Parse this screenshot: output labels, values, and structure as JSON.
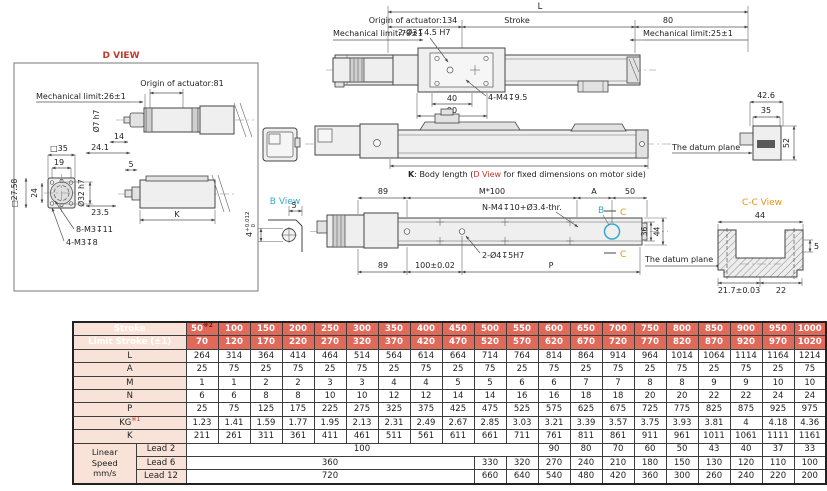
{
  "colors": {
    "header_bg": "#e0695a",
    "label_bg": "#f9e3d8",
    "accent_red": "#c0392b",
    "accent_cyan": "#33acce",
    "accent_orange": "#e8940e",
    "line": "#444444"
  },
  "d_view": {
    "title": "D VIEW",
    "origin": "Origin of actuator:81",
    "mech_limit": "Mechanical limit:26±1",
    "shaft_dia": "Ø7 h7",
    "d14": "14",
    "d24_1": "24.1",
    "sq35": "□35",
    "d19": "19",
    "sq27_58": "□27.58",
    "d24": "24",
    "dia32": "Ø32 h7",
    "d23_5": "23.5",
    "d5": "5",
    "k": "K",
    "thread8": "8-M3↧11",
    "thread4": "4-M3↧8"
  },
  "top_view": {
    "l": "L",
    "origin": "Origin of actuator:134",
    "stroke": "Stroke",
    "d80": "80",
    "mech_limit_left": "Mechanical limit:79±1",
    "mech_limit_right": "Mechanical limit:25±1",
    "holes": "2-Ø3↧4.5 H7",
    "threads": "4-M4↧9.5",
    "d40": "40",
    "d90": "90"
  },
  "front_view": {
    "k_bold": "K",
    "k_mid": ": Body length (",
    "k_dview": "D View",
    "k_post": " for fixed dimensions on motor side)",
    "datum": "The datum plane",
    "d42_6": "42.6",
    "d35": "35",
    "d52": "52"
  },
  "bottom_view": {
    "title": "B View",
    "d5": "5",
    "tol_base": "4",
    "tol_hi": "+0.012",
    "tol_lo": "0",
    "d89_top": "89",
    "m100": "M*100",
    "a": "A",
    "d50": "50",
    "n_threads": "N-M4↧10+Ø3.4-thr.",
    "b": "B",
    "c": "C",
    "d36": "36",
    "d44": "44",
    "d89_bot": "89",
    "d100": "100±0.02",
    "p": "P",
    "holes": "2-Ø4↧5H7",
    "datum": "The datum plane"
  },
  "cc_view": {
    "title": "C-C View",
    "d44": "44",
    "d5": "5",
    "d21_7": "21.7±0.03",
    "d22": "22"
  },
  "table": {
    "stroke_label": "Stroke",
    "stroke_sup": "※2",
    "limit_label": "Limit Stroke (±1)",
    "strokes": [
      "50",
      "100",
      "150",
      "200",
      "250",
      "300",
      "350",
      "400",
      "450",
      "500",
      "550",
      "600",
      "650",
      "700",
      "750",
      "800",
      "850",
      "900",
      "950",
      "1000"
    ],
    "limit_strokes": [
      "70",
      "120",
      "170",
      "220",
      "270",
      "320",
      "370",
      "420",
      "470",
      "520",
      "570",
      "620",
      "670",
      "720",
      "770",
      "820",
      "870",
      "920",
      "970",
      "1020"
    ],
    "rows": [
      {
        "label": "L",
        "sup": "",
        "values": [
          "264",
          "314",
          "364",
          "414",
          "464",
          "514",
          "564",
          "614",
          "664",
          "714",
          "764",
          "814",
          "864",
          "914",
          "964",
          "1014",
          "1064",
          "1114",
          "1164",
          "1214"
        ]
      },
      {
        "label": "A",
        "sup": "",
        "values": [
          "25",
          "75",
          "25",
          "75",
          "25",
          "75",
          "25",
          "75",
          "25",
          "75",
          "25",
          "75",
          "25",
          "75",
          "25",
          "75",
          "25",
          "75",
          "25",
          "75"
        ]
      },
      {
        "label": "M",
        "sup": "",
        "values": [
          "1",
          "1",
          "2",
          "2",
          "3",
          "3",
          "4",
          "4",
          "5",
          "5",
          "6",
          "6",
          "7",
          "7",
          "8",
          "8",
          "9",
          "9",
          "10",
          "10"
        ]
      },
      {
        "label": "N",
        "sup": "",
        "values": [
          "6",
          "6",
          "8",
          "8",
          "10",
          "10",
          "12",
          "12",
          "14",
          "14",
          "16",
          "16",
          "18",
          "18",
          "20",
          "20",
          "22",
          "22",
          "24",
          "24"
        ]
      },
      {
        "label": "P",
        "sup": "",
        "values": [
          "25",
          "75",
          "125",
          "175",
          "225",
          "275",
          "325",
          "375",
          "425",
          "475",
          "525",
          "575",
          "625",
          "675",
          "725",
          "775",
          "825",
          "875",
          "925",
          "975"
        ]
      },
      {
        "label": "KG",
        "sup": "※1",
        "values": [
          "1.23",
          "1.41",
          "1.59",
          "1.77",
          "1.95",
          "2.13",
          "2.31",
          "2.49",
          "2.67",
          "2.85",
          "3.03",
          "3.21",
          "3.39",
          "3.57",
          "3.75",
          "3.93",
          "3.81",
          "4",
          "4.18",
          "4.36"
        ]
      },
      {
        "label": "K",
        "sup": "",
        "values": [
          "211",
          "261",
          "311",
          "361",
          "411",
          "461",
          "511",
          "561",
          "611",
          "661",
          "711",
          "761",
          "811",
          "861",
          "911",
          "961",
          "1011",
          "1061",
          "1111",
          "1161"
        ]
      }
    ],
    "linear_speed": {
      "group_label_lines": [
        "Linear",
        "Speed",
        "mm/s"
      ],
      "rows": [
        {
          "label": "Lead 2",
          "span": 11,
          "span_value": "100",
          "values": [
            "90",
            "80",
            "70",
            "60",
            "50",
            "43",
            "40",
            "37",
            "33"
          ]
        },
        {
          "label": "Lead 6",
          "span": 9,
          "span_value": "360",
          "values": [
            "330",
            "320",
            "270",
            "240",
            "210",
            "180",
            "150",
            "130",
            "120",
            "110",
            "100"
          ]
        },
        {
          "label": "Lead 12",
          "span": 9,
          "span_value": "720",
          "values": [
            "660",
            "640",
            "540",
            "480",
            "420",
            "360",
            "300",
            "260",
            "240",
            "220",
            "200"
          ]
        }
      ]
    }
  }
}
